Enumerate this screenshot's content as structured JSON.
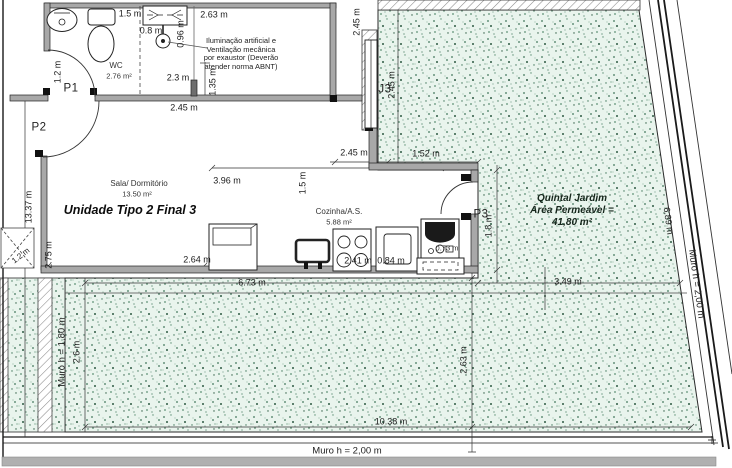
{
  "plan": {
    "unit_title": "Unidade Tipo 2 Final 3",
    "rooms": {
      "wc": {
        "name": "WC",
        "area": "2.76 m²"
      },
      "sala": {
        "name": "Sala/ Dormitório",
        "area": "13.50 m²"
      },
      "cozinha": {
        "name": "Cozinha/A.S.",
        "area": "5.88 m²"
      },
      "garden": {
        "name": "Quintal Jardim",
        "line2": "Área Permeável =",
        "area": "41,80 m²"
      }
    },
    "note": {
      "line1": "Iluminação artificial e",
      "line2": "Ventilação mecânica",
      "line3": "por exaustor (Deverão",
      "line4": "atender norma ABNT)"
    },
    "doors": {
      "p1": "P1",
      "p2": "P2",
      "p3": "P3"
    },
    "windows": {
      "j3": "J3"
    },
    "walls": {
      "muro_left": "Muro h = 1,80 m",
      "muro_bottom": "Muro h = 2,00 m",
      "muro_right": "Muro h = 2,00 m"
    },
    "dimensions": {
      "top_1_5": "1.5 m",
      "top_2_63": "2.63 m",
      "shower_0_8": "0.8 m",
      "shower_0_96": "0.96 m",
      "wc_2_3": "2.3 m",
      "wc_2_45": "2.45 m",
      "p1_1_2": "1.2 m",
      "vent_1_35": "1.35 m",
      "tr_2_45": "2.45 m",
      "garden_v_2_45": "2.45 m",
      "h_2_45": "2.45 m",
      "h_1_52": "1.52 m",
      "left_13_37": "13.37 m",
      "sala_2_75": "2.75 m",
      "sala_2_64": "2.64 m",
      "sala_3_96": "3.96 m",
      "koz_1_5": "1.5 m",
      "koz_2_41": "2.41 m",
      "koz_0_84": "0.84 m",
      "koz_0_73": "0.73 m",
      "p3_1_8": "1.8 m",
      "garden_2_63": "2.63 m",
      "bot_6_73": "6.73 m",
      "bot_3_49": "3.49 m",
      "bot_10_38": "10.38 m",
      "left_2_6": "2.6 m",
      "right_6_89": "6.89 m",
      "ramp_1_2": "1.2 m"
    },
    "palette": {
      "garden_fill": "#e9f4ed",
      "garden_dot": "#40745a",
      "wall_fill": "#a8a8a8",
      "boundary": "#1a1a1a"
    }
  }
}
